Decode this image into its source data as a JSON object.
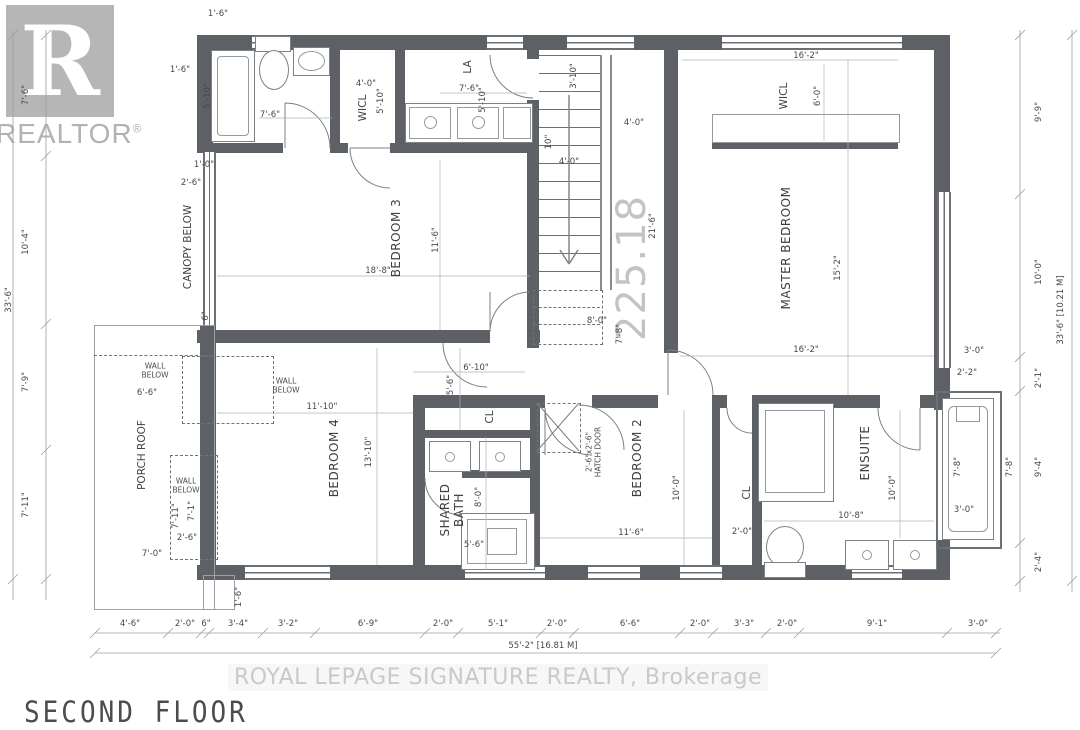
{
  "title": "SECOND FLOOR",
  "branding": {
    "logo_letter": "R",
    "logo_wordmark": "REALTOR",
    "logo_registered": "®",
    "brokerage_watermark": "ROYAL LEPAGE SIGNATURE REALTY, Brokerage",
    "plan_area_watermark": "225.18"
  },
  "colors": {
    "wall": "#5d6165",
    "dim": "#44484c",
    "wm": "#c9c9c9"
  },
  "plan": {
    "rooms": [
      {
        "label": "BEDROOM 3",
        "x": 397,
        "y": 238,
        "r": "v",
        "s": "room"
      },
      {
        "label": "BEDROOM 4",
        "x": 335,
        "y": 458,
        "r": "v",
        "s": "room"
      },
      {
        "label": "BEDROOM 2",
        "x": 638,
        "y": 458,
        "r": "v",
        "s": "room"
      },
      {
        "label": "MASTER BEDROOM",
        "x": 787,
        "y": 248,
        "r": "v",
        "s": "room"
      },
      {
        "label": "ENSUITE",
        "x": 866,
        "y": 453,
        "r": "v",
        "s": "room"
      },
      {
        "label": "SHARED\nBATH",
        "x": 453,
        "y": 510,
        "r": "v",
        "s": "room"
      },
      {
        "label": "WICL",
        "x": 363,
        "y": 108,
        "r": "v",
        "s": "md"
      },
      {
        "label": "WICL",
        "x": 784,
        "y": 96,
        "r": "v",
        "s": "md"
      },
      {
        "label": "LA",
        "x": 468,
        "y": 67,
        "r": "v",
        "s": "md"
      },
      {
        "label": "CL",
        "x": 490,
        "y": 417,
        "r": "v",
        "s": "md"
      },
      {
        "label": "CL",
        "x": 747,
        "y": 493,
        "r": "v",
        "s": "md"
      },
      {
        "label": "CANOPY BELOW",
        "x": 188,
        "y": 247,
        "r": "v",
        "s": "md"
      },
      {
        "label": "PORCH ROOF",
        "x": 142,
        "y": 455,
        "r": "v",
        "s": "md"
      },
      {
        "label": "WALL\nBELOW",
        "x": 155,
        "y": 371,
        "r": "h",
        "s": "sm"
      },
      {
        "label": "WALL\nBELOW",
        "x": 286,
        "y": 386,
        "r": "h",
        "s": "sm"
      },
      {
        "label": "WALL\nBELOW",
        "x": 186,
        "y": 486,
        "r": "h",
        "s": "sm"
      },
      {
        "label": "2'-6\"x2'-6\"\nHATCH DOOR",
        "x": 594,
        "y": 452,
        "r": "v",
        "s": "sm"
      }
    ],
    "dimensions": [
      {
        "t": "7'-6\"",
        "x": 27,
        "y": 95,
        "r": "v"
      },
      {
        "t": "10'-4\"",
        "x": 27,
        "y": 242,
        "r": "v"
      },
      {
        "t": "7'-9\"",
        "x": 27,
        "y": 382,
        "r": "v"
      },
      {
        "t": "7'-11\"",
        "x": 27,
        "y": 505,
        "r": "v"
      },
      {
        "t": "33'-6\"",
        "x": 10,
        "y": 300,
        "r": "v"
      },
      {
        "t": "1'-6\"",
        "x": 218,
        "y": 15,
        "r": "h"
      },
      {
        "t": "1'-6\"",
        "x": 180,
        "y": 71,
        "r": "h"
      },
      {
        "t": "5'-10\"",
        "x": 209,
        "y": 96,
        "r": "v"
      },
      {
        "t": "7'-6\"",
        "x": 270,
        "y": 116,
        "r": "h"
      },
      {
        "t": "4'-0\"",
        "x": 366,
        "y": 85,
        "r": "h"
      },
      {
        "t": "5'-10\"",
        "x": 382,
        "y": 101,
        "r": "v"
      },
      {
        "t": "7'-6\"",
        "x": 469,
        "y": 90,
        "r": "h"
      },
      {
        "t": "5'-10\"",
        "x": 484,
        "y": 100,
        "r": "v"
      },
      {
        "t": "3'-10\"",
        "x": 575,
        "y": 76,
        "r": "v"
      },
      {
        "t": "4'-0\"",
        "x": 634,
        "y": 124,
        "r": "h"
      },
      {
        "t": "10\"",
        "x": 550,
        "y": 142,
        "r": "v"
      },
      {
        "t": "4'-0\"",
        "x": 569,
        "y": 163,
        "r": "h"
      },
      {
        "t": "16'-2\"",
        "x": 806,
        "y": 57,
        "r": "h"
      },
      {
        "t": "6'-0\"",
        "x": 819,
        "y": 96,
        "r": "v"
      },
      {
        "t": "9'-9\"",
        "x": 1040,
        "y": 112,
        "r": "v"
      },
      {
        "t": "10'-0\"",
        "x": 1040,
        "y": 272,
        "r": "v"
      },
      {
        "t": "33'-6\" [10.21 M]",
        "x": 1062,
        "y": 310,
        "r": "v"
      },
      {
        "t": "1'-0\"",
        "x": 204,
        "y": 166,
        "r": "h"
      },
      {
        "t": "2'-6\"",
        "x": 191,
        "y": 184,
        "r": "h"
      },
      {
        "t": "18'-8\"",
        "x": 378,
        "y": 272,
        "r": "h"
      },
      {
        "t": "11'-6\"",
        "x": 437,
        "y": 240,
        "r": "v"
      },
      {
        "t": "21'-6\"",
        "x": 654,
        "y": 226,
        "r": "v"
      },
      {
        "t": "15'-2\"",
        "x": 839,
        "y": 268,
        "r": "v"
      },
      {
        "t": "16'-2\"",
        "x": 806,
        "y": 351,
        "r": "h"
      },
      {
        "t": "6\"",
        "x": 207,
        "y": 316,
        "r": "v"
      },
      {
        "t": "8'-0\"",
        "x": 597,
        "y": 322,
        "r": "h"
      },
      {
        "t": "7'-8\"",
        "x": 621,
        "y": 334,
        "r": "v"
      },
      {
        "t": "3'-0\"",
        "x": 974,
        "y": 352,
        "r": "h"
      },
      {
        "t": "2'-2\"",
        "x": 967,
        "y": 374,
        "r": "h"
      },
      {
        "t": "2'-1\"",
        "x": 1040,
        "y": 378,
        "r": "v"
      },
      {
        "t": "6'-6\"",
        "x": 147,
        "y": 394,
        "r": "h"
      },
      {
        "t": "11'-10\"",
        "x": 322,
        "y": 408,
        "r": "h"
      },
      {
        "t": "6'-10\"",
        "x": 476,
        "y": 369,
        "r": "h"
      },
      {
        "t": "5'-6\"",
        "x": 452,
        "y": 385,
        "r": "v"
      },
      {
        "t": "13'-10\"",
        "x": 370,
        "y": 452,
        "r": "v"
      },
      {
        "t": "10'-0\"",
        "x": 678,
        "y": 488,
        "r": "v"
      },
      {
        "t": "8'-0\"",
        "x": 480,
        "y": 497,
        "r": "v"
      },
      {
        "t": "5'-6\"",
        "x": 474,
        "y": 546,
        "r": "h"
      },
      {
        "t": "11'-6\"",
        "x": 631,
        "y": 534,
        "r": "h"
      },
      {
        "t": "2'-0\"",
        "x": 742,
        "y": 533,
        "r": "h"
      },
      {
        "t": "10'-0\"",
        "x": 894,
        "y": 488,
        "r": "v"
      },
      {
        "t": "10'-8\"",
        "x": 851,
        "y": 517,
        "r": "h"
      },
      {
        "t": "3'-0\"",
        "x": 964,
        "y": 511,
        "r": "h"
      },
      {
        "t": "7'-8\"",
        "x": 959,
        "y": 467,
        "r": "v"
      },
      {
        "t": "7'-8\"",
        "x": 1011,
        "y": 467,
        "r": "v"
      },
      {
        "t": "9'-4\"",
        "x": 1040,
        "y": 467,
        "r": "v"
      },
      {
        "t": "2'-4\"",
        "x": 1040,
        "y": 562,
        "r": "v"
      },
      {
        "t": "7'-11\"",
        "x": 177,
        "y": 516,
        "r": "v"
      },
      {
        "t": "7'-1\"",
        "x": 193,
        "y": 511,
        "r": "v"
      },
      {
        "t": "2'-6\"",
        "x": 187,
        "y": 539,
        "r": "h"
      },
      {
        "t": "7'-0\"",
        "x": 152,
        "y": 555,
        "r": "h"
      },
      {
        "t": "1'-6\"",
        "x": 240,
        "y": 597,
        "r": "v"
      },
      {
        "t": "4'-6\"",
        "x": 130,
        "y": 625,
        "r": "h"
      },
      {
        "t": "2'-0\"",
        "x": 185,
        "y": 625,
        "r": "h"
      },
      {
        "t": "6\"",
        "x": 206,
        "y": 625,
        "r": "h"
      },
      {
        "t": "3'-4\"",
        "x": 238,
        "y": 625,
        "r": "h"
      },
      {
        "t": "3'-2\"",
        "x": 288,
        "y": 625,
        "r": "h"
      },
      {
        "t": "6'-9\"",
        "x": 368,
        "y": 625,
        "r": "h"
      },
      {
        "t": "2'-0\"",
        "x": 443,
        "y": 625,
        "r": "h"
      },
      {
        "t": "5'-1\"",
        "x": 498,
        "y": 625,
        "r": "h"
      },
      {
        "t": "2'-0\"",
        "x": 557,
        "y": 625,
        "r": "h"
      },
      {
        "t": "6'-6\"",
        "x": 630,
        "y": 625,
        "r": "h"
      },
      {
        "t": "2'-0\"",
        "x": 700,
        "y": 625,
        "r": "h"
      },
      {
        "t": "3'-3\"",
        "x": 744,
        "y": 625,
        "r": "h"
      },
      {
        "t": "2'-0\"",
        "x": 787,
        "y": 625,
        "r": "h"
      },
      {
        "t": "9'-1\"",
        "x": 877,
        "y": 625,
        "r": "h"
      },
      {
        "t": "3'-0\"",
        "x": 978,
        "y": 625,
        "r": "h"
      },
      {
        "t": "55'-2\" [16.81 M]",
        "x": 543,
        "y": 647,
        "r": "h"
      }
    ]
  }
}
